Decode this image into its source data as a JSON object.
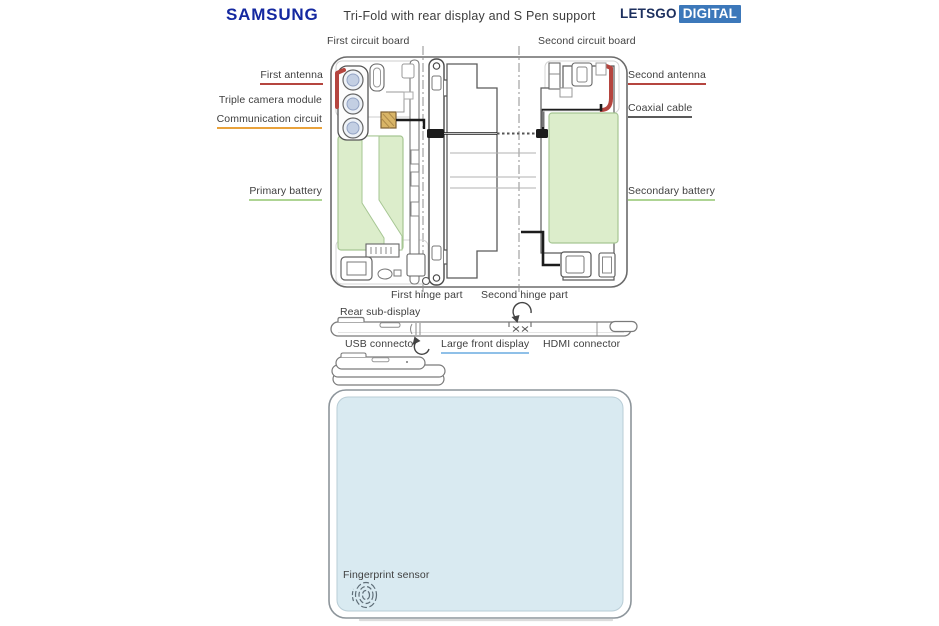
{
  "header": {
    "brand": "SAMSUNG",
    "title": "Tri-Fold with rear display and S Pen support",
    "logo_text": "LETSGO",
    "logo_badge": "DIGITAL"
  },
  "labels": {
    "first_circuit_board": "First circuit board",
    "second_circuit_board": "Second circuit board",
    "first_antenna": "First antenna",
    "triple_camera_module": "Triple camera module",
    "communication_circuit": "Communication circuit",
    "second_antenna": "Second antenna",
    "coaxial_cable": "Coaxial cable",
    "primary_battery": "Primary battery",
    "secondary_battery": "Secondary battery",
    "first_hinge_part": "First hinge part",
    "second_hinge_part": "Second hinge part",
    "rear_sub_display": "Rear sub-display",
    "usb_connector": "USB connector",
    "large_front_display": "Large front display",
    "hdmi_connector": "HDMI connector",
    "fingerprint_sensor": "Fingerprint sensor"
  },
  "colors": {
    "samsung_blue": "#1428a0",
    "logo_navy": "#1c2f5e",
    "logo_badge_blue": "#3c78ba",
    "label_text": "#3f3f3f",
    "antenna_red": "#b5453f",
    "communication_orange": "#e9a23b",
    "communication_chip_fill": "#d9b567",
    "battery_green_fill": "#dcedcb",
    "battery_green_stroke": "#a6c693",
    "battery_green_underline": "#aed494",
    "display_blue_underline": "#8fc0e8",
    "coax_underline": "#5a5a5a",
    "cable_black": "#1c1c1c",
    "screen_fill": "#d9eaf1",
    "lens_fill": "#c3cfe3"
  }
}
